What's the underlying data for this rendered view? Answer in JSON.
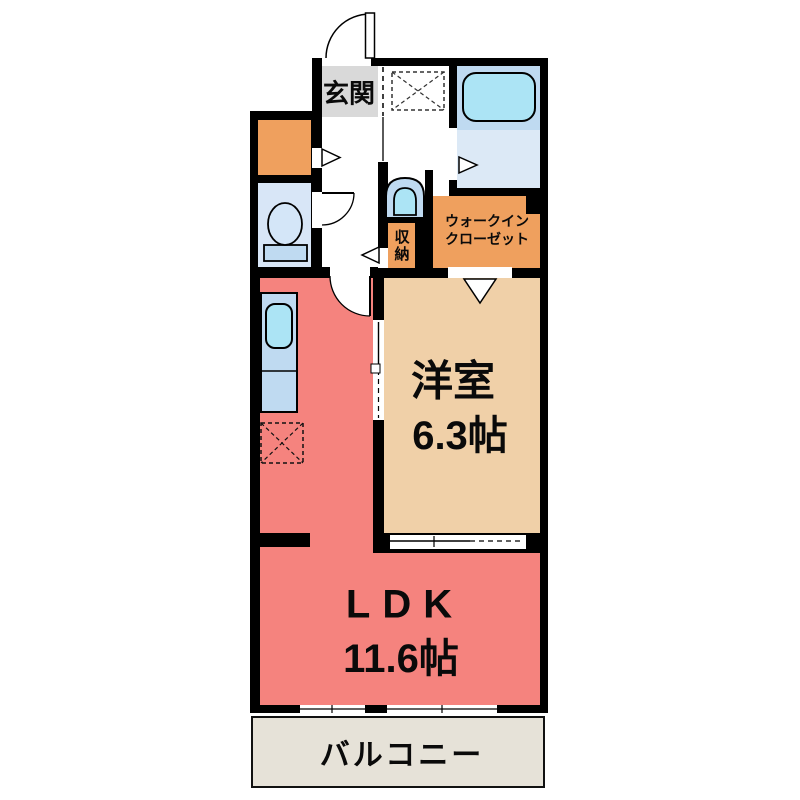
{
  "floorplan": {
    "rooms": {
      "entrance": {
        "label": "玄関"
      },
      "hall_storage": {
        "label": "収納"
      },
      "walk_in_closet": {
        "line1": "ウォークイン",
        "line2": "クローゼット"
      },
      "western_room": {
        "label": "洋室",
        "size": "6.3帖"
      },
      "ldk": {
        "label": "LDK",
        "size": "11.6帖"
      },
      "balcony": {
        "label": "バルコニー"
      }
    },
    "icons": {
      "bathtub": "bathtub-icon",
      "washbasin": "washbasin-icon",
      "toilet": "toilet-icon",
      "kitchen_sink": "kitchen-sink-icon",
      "washer_space": "washing-machine-space-icon",
      "fridge_space": "refrigerator-space-icon"
    },
    "colors": {
      "wall": "#000000",
      "ldk_fill": "#f5837e",
      "western_room_fill": "#f0d0a8",
      "closet_fill": "#efa05e",
      "entrance_fill": "#d9d9d9",
      "counter_fill": "#bfdaf1",
      "fixture_fill": "#ace4f5",
      "toilet_room_fill": "#d8e6f7",
      "bath_floor_fill": "#dce9f6",
      "balcony_fill": "#e6e2d8"
    }
  }
}
